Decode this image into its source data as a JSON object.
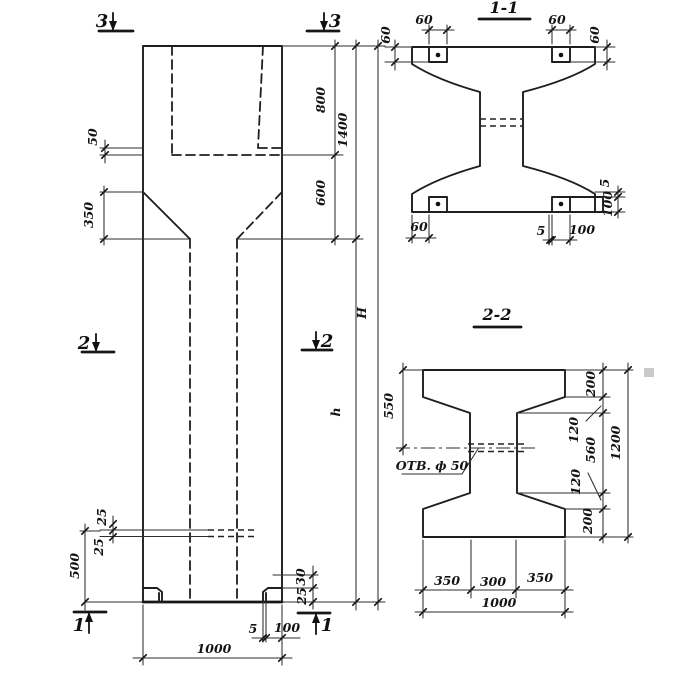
{
  "elevation": {
    "marks": {
      "top_left": "3",
      "top_right": "3",
      "mid_left": "2",
      "mid_right": "2",
      "bottom_left": "1",
      "bottom_right": "1"
    },
    "dims": {
      "plate_gap": "50",
      "corbel": "350",
      "head_top": "800",
      "head_total": "1400",
      "neck": "600",
      "total_height": "H",
      "shaft_height": "h",
      "tie_upper": "25",
      "tie_lower": "25",
      "base": "500",
      "foot_upper": "30",
      "foot_lower": "25",
      "foot_lip": "5",
      "foot_width": "100",
      "width": "1000"
    }
  },
  "s11": {
    "title": "1-1",
    "dims": {
      "tl_w": "60",
      "tl_h": "60",
      "tr_w": "60",
      "tr_h": "60",
      "bl": "60",
      "br_lip": "5",
      "br_w": "100",
      "r_lip": "5",
      "r_h": "100"
    }
  },
  "s22": {
    "title": "2-2",
    "hole": "ОТВ. ф 50",
    "dims": {
      "half": "550",
      "f_top": "200",
      "fil_top": "120",
      "web": "560",
      "fil_bot": "120",
      "f_bot": "200",
      "height": "1200",
      "b_l": "350",
      "b_m": "300",
      "b_r": "350",
      "b_total": "1000"
    }
  }
}
